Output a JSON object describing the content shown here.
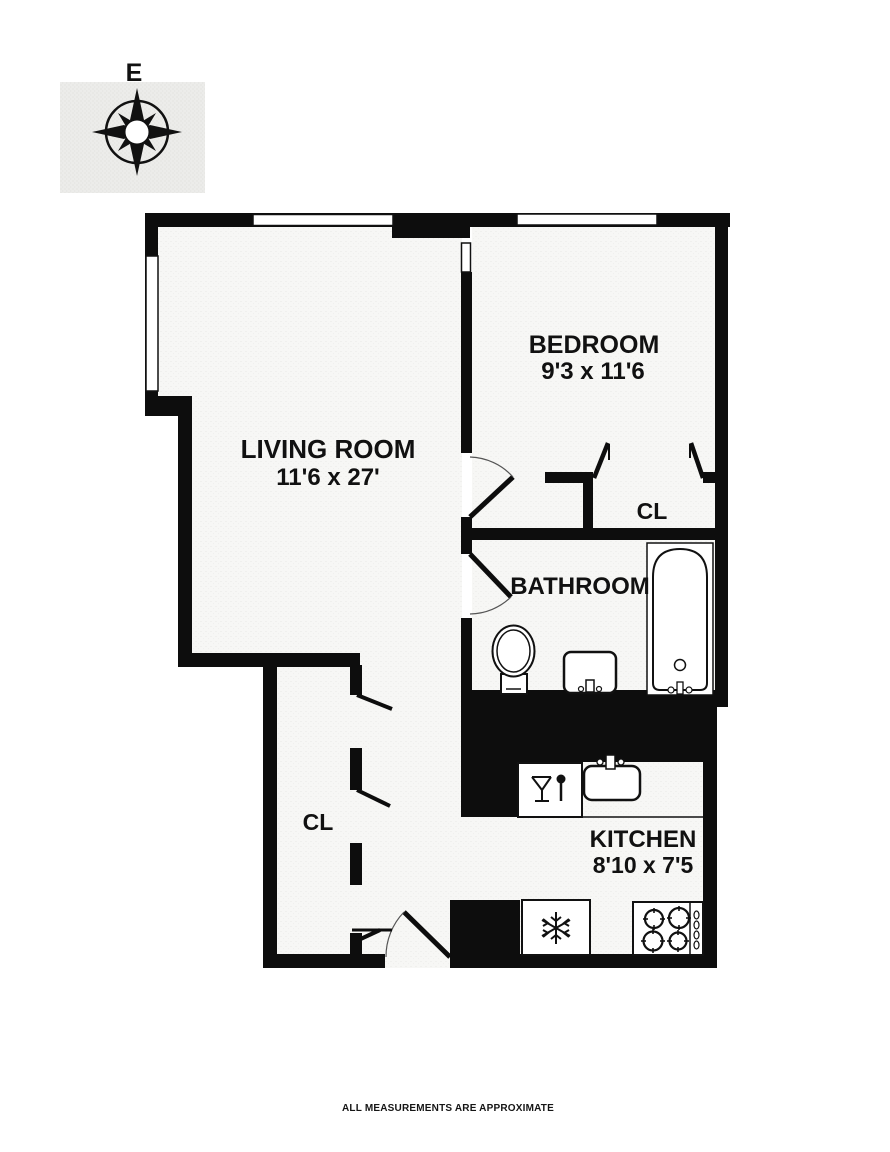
{
  "page": {
    "type": "apartment-floor-plan",
    "footer_note": "ALL MEASUREMENTS ARE APPROXIMATE"
  },
  "compass": {
    "label": "E"
  },
  "rooms": {
    "living_room": {
      "name": "LIVING ROOM",
      "dims": "11'6 x 27'"
    },
    "bedroom": {
      "name": "BEDROOM",
      "dims": "9'3 x 11'6"
    },
    "bathroom": {
      "name": "BATHROOM"
    },
    "kitchen": {
      "name": "KITCHEN",
      "dims": "8'10 x 7'5"
    },
    "bedroom_closet": {
      "name": "CL"
    },
    "hall_closet": {
      "name": "CL"
    }
  },
  "fixtures": [
    "toilet-icon",
    "bathroom-sink-icon",
    "bathtub-icon",
    "dishwasher-icon",
    "kitchen-sink-icon",
    "refrigerator-icon",
    "stove-4-burner-icon"
  ],
  "colors": {
    "wall": "#0d0d0d",
    "floor": "#f7f7f5",
    "background": "#ffffff",
    "compass_panel": "#ededeb"
  }
}
